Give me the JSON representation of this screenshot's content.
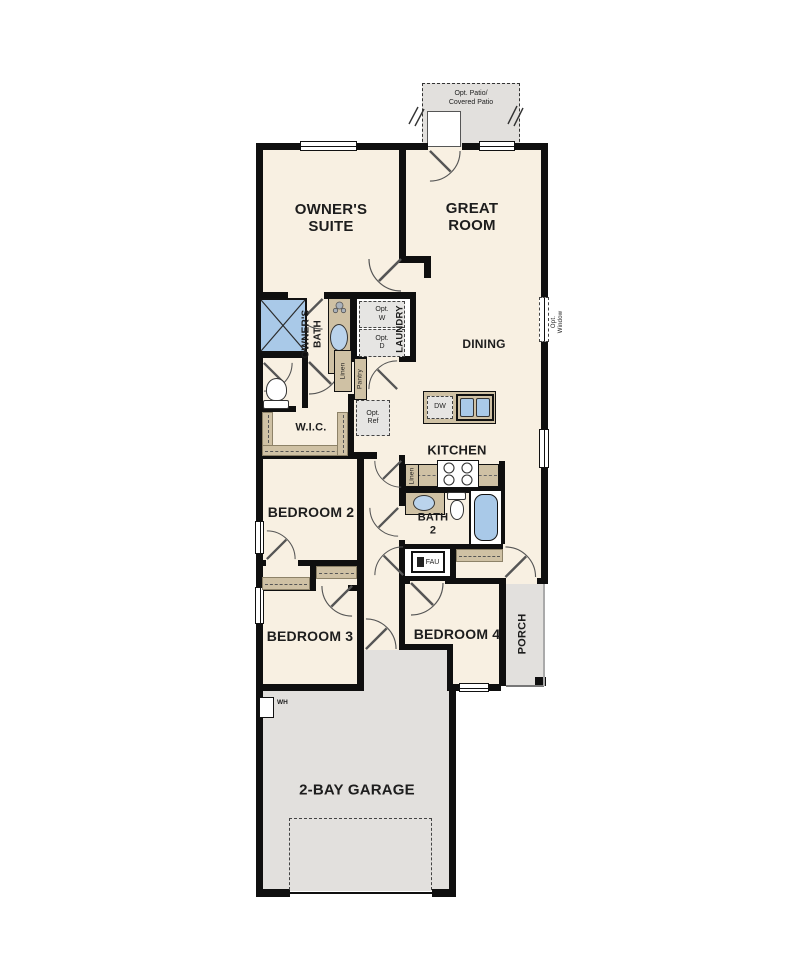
{
  "floorplan": {
    "rooms": {
      "owners_suite": "OWNER'S SUITE",
      "great_room": "GREAT ROOM",
      "dining": "DINING",
      "kitchen": "KITCHEN",
      "owners_bath": "OWNER'S BATH",
      "laundry": "LAUNDRY",
      "wic": "W.I.C.",
      "bedroom2": "BEDROOM 2",
      "bedroom3": "BEDROOM 3",
      "bedroom4": "BEDROOM 4",
      "bath2": [
        "BATH",
        "2"
      ],
      "porch": "PORCH",
      "garage": "2-BAY GARAGE",
      "patio": [
        "Opt. Patio/",
        "Covered Patio"
      ]
    },
    "labels": {
      "opt_washer": [
        "Opt.",
        "W"
      ],
      "opt_dryer": [
        "Opt.",
        "D"
      ],
      "opt_ref": [
        "Opt.",
        "Ref"
      ],
      "opt_window": [
        "Opt.",
        "Window"
      ],
      "dishwasher": "DW",
      "fau": "FAU",
      "water_heater": "WH",
      "linen_bath": "Linen",
      "linen_kitchen": "Linen",
      "pantry": "Pantry"
    },
    "colors": {
      "wall": "#0f0f0f",
      "floor": "#f8f0e2",
      "concrete": "#e2e0dd",
      "cabinet": "#cfc1a4",
      "fixture_blue": "#a9c9e8",
      "optional_fill": "#e6e5e3"
    }
  }
}
